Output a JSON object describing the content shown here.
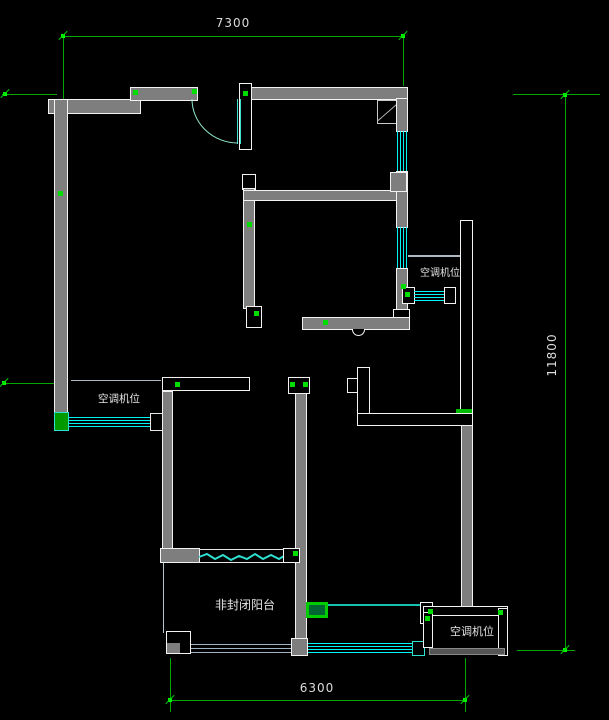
{
  "dimensions": {
    "top": "7300",
    "right": "11800",
    "bottom": "6300"
  },
  "labels": {
    "ac_left": "空调机位",
    "ac_right": "空调机位",
    "ac_bottom": "空调机位",
    "balcony": "非封闭阳台"
  },
  "colors": {
    "background": "#000000",
    "wall_fill": "#7e7e7e",
    "wall_outline": "#f2f2f2",
    "window_cyan": "#00ffff",
    "dimension_green": "#00a800",
    "marker_green": "#00dd00",
    "highlight_green": "#00cc00",
    "door_arc": "#8fe8d0",
    "text": "#dcdcdc"
  }
}
